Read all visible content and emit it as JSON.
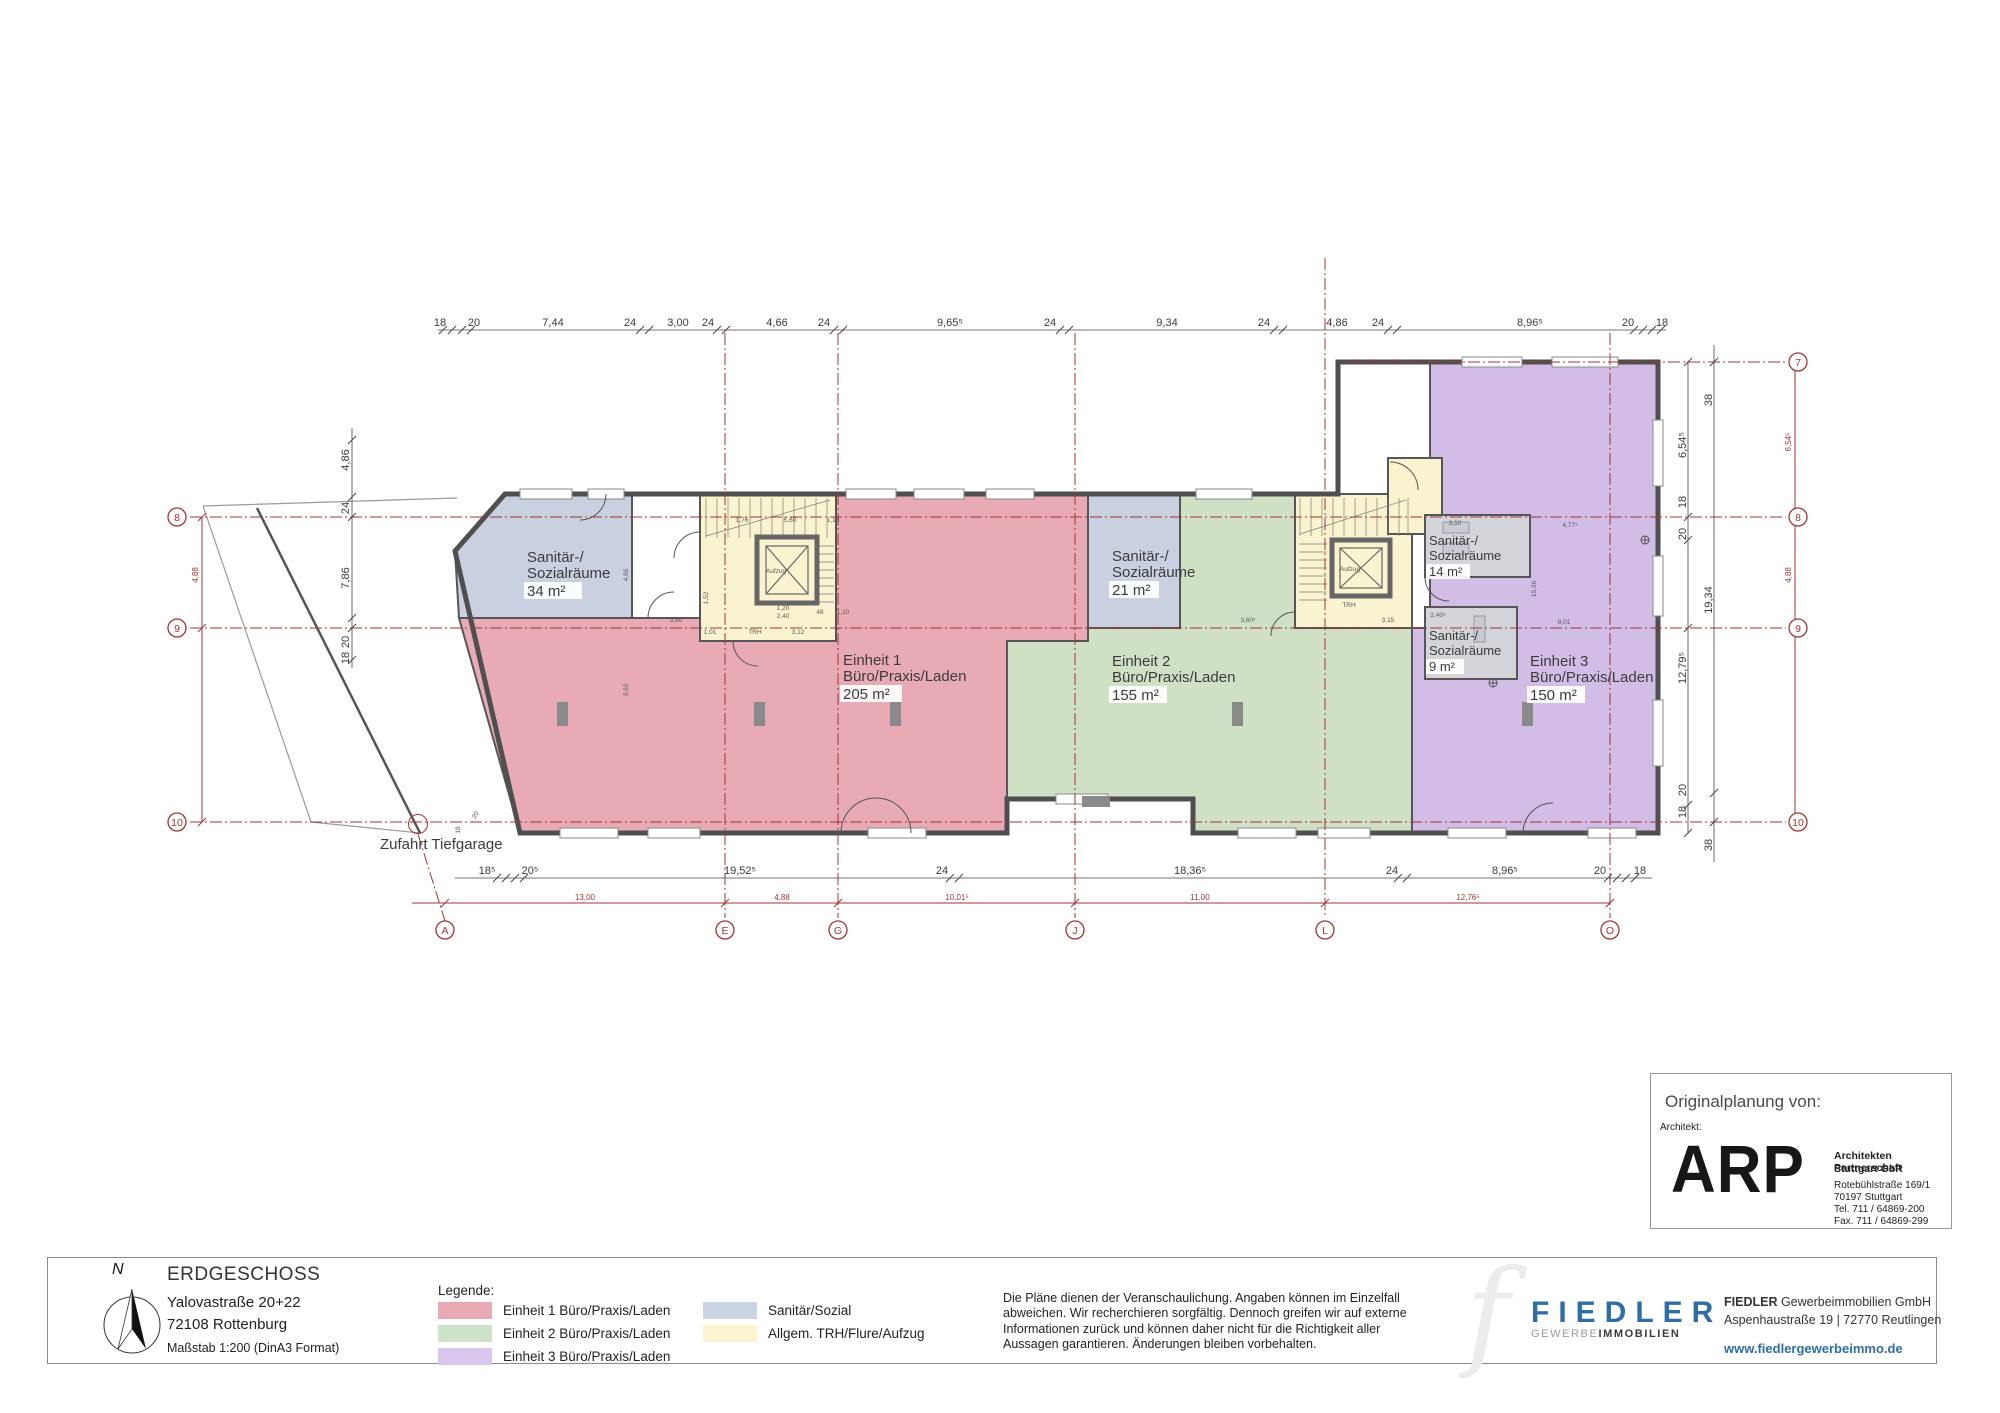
{
  "plan": {
    "colors": {
      "einheit1": "#e8aab4",
      "einheit2": "#cfe0c4",
      "einheit3": "#d2bde7",
      "sanitaer": "#c9d1e0",
      "sanitaer_block": "#d4d5da",
      "trh": "#faf3cf",
      "grid_red": "#a33434"
    },
    "rooms": {
      "s34": [
        "Sanitär-/",
        "Sozialräume",
        "34 m²"
      ],
      "e1": [
        "Einheit 1",
        "Büro/Praxis/Laden",
        "205 m²"
      ],
      "s21": [
        "Sanitär-/",
        "Sozialräume",
        "21 m²"
      ],
      "e2": [
        "Einheit 2",
        "Büro/Praxis/Laden",
        "155 m²"
      ],
      "s14": [
        "Sanitär-/",
        "Sozialräume",
        "14 m²"
      ],
      "s9": [
        "Sanitär-/",
        "Sozialräume",
        "9 m²"
      ],
      "e3": [
        "Einheit 3",
        "Büro/Praxis/Laden",
        "150 m²"
      ]
    },
    "zufahrt_label": "Zufahrt Tiefgarage",
    "grid_bubbles": [
      {
        "t": "8",
        "x": 177,
        "y": 521
      },
      {
        "t": "9",
        "x": 177,
        "y": 632
      },
      {
        "t": "10",
        "x": 177,
        "y": 826
      },
      {
        "t": "7",
        "x": 1798,
        "y": 366
      },
      {
        "t": "8",
        "x": 1798,
        "y": 521
      },
      {
        "t": "9",
        "x": 1798,
        "y": 632
      },
      {
        "t": "10",
        "x": 1798,
        "y": 826
      },
      {
        "t": "A",
        "x": 445,
        "y": 934
      },
      {
        "t": "E",
        "x": 725,
        "y": 934
      },
      {
        "t": "G",
        "x": 838,
        "y": 934
      },
      {
        "t": "J",
        "x": 1075,
        "y": 934
      },
      {
        "t": "L",
        "x": 1325,
        "y": 934
      },
      {
        "t": "O",
        "x": 1610,
        "y": 934
      }
    ],
    "top_dims": [
      {
        "t": "18",
        "x": 440,
        "y": 326
      },
      {
        "t": "20",
        "x": 474,
        "y": 326
      },
      {
        "t": "7,44",
        "x": 553,
        "y": 326
      },
      {
        "t": "24",
        "x": 630,
        "y": 326
      },
      {
        "t": "3,00",
        "x": 678,
        "y": 326
      },
      {
        "t": "24",
        "x": 708,
        "y": 326
      },
      {
        "t": "4,66",
        "x": 777,
        "y": 326
      },
      {
        "t": "24",
        "x": 824,
        "y": 326
      },
      {
        "t": "9,65⁵",
        "x": 950,
        "y": 326
      },
      {
        "t": "24",
        "x": 1050,
        "y": 326
      },
      {
        "t": "9,34",
        "x": 1167,
        "y": 326
      },
      {
        "t": "24",
        "x": 1264,
        "y": 326
      },
      {
        "t": "4,86",
        "x": 1337,
        "y": 326
      },
      {
        "t": "24",
        "x": 1378,
        "y": 326
      },
      {
        "t": "8,96⁵",
        "x": 1530,
        "y": 326
      },
      {
        "t": "20",
        "x": 1628,
        "y": 326
      },
      {
        "t": "18",
        "x": 1662,
        "y": 326
      }
    ],
    "bottom_dims": [
      {
        "t": "18⁵",
        "x": 487,
        "y": 874
      },
      {
        "t": "20⁵",
        "x": 530,
        "y": 874
      },
      {
        "t": "19,52⁵",
        "x": 740,
        "y": 874
      },
      {
        "t": "24",
        "x": 942,
        "y": 874
      },
      {
        "t": "18,36⁵",
        "x": 1190,
        "y": 874
      },
      {
        "t": "24",
        "x": 1392,
        "y": 874
      },
      {
        "t": "8,96⁵",
        "x": 1505,
        "y": 874
      },
      {
        "t": "20",
        "x": 1600,
        "y": 874
      },
      {
        "t": "18",
        "x": 1640,
        "y": 874
      }
    ],
    "red_dims": [
      {
        "t": "13,00",
        "x": 585,
        "y": 900
      },
      {
        "t": "4,88",
        "x": 782,
        "y": 900
      },
      {
        "t": "10,01⁵",
        "x": 957,
        "y": 900
      },
      {
        "t": "11,00",
        "x": 1200,
        "y": 900
      },
      {
        "t": "12,76⁵",
        "x": 1468,
        "y": 900
      }
    ],
    "side_dims": [
      {
        "t": "4,86",
        "x": 349,
        "y": 460,
        "r": -90
      },
      {
        "t": "24",
        "x": 349,
        "y": 508,
        "r": -90
      },
      {
        "t": "7,86",
        "x": 349,
        "y": 578,
        "r": -90
      },
      {
        "t": "20",
        "x": 349,
        "y": 642,
        "r": -90
      },
      {
        "t": "18",
        "x": 349,
        "y": 658,
        "r": -90
      },
      {
        "t": "38",
        "x": 1712,
        "y": 400,
        "r": -90
      },
      {
        "t": "6,54⁵",
        "x": 1686,
        "y": 445,
        "r": -90
      },
      {
        "t": "18",
        "x": 1686,
        "y": 502,
        "r": -90
      },
      {
        "t": "20",
        "x": 1686,
        "y": 534,
        "r": -90
      },
      {
        "t": "19,34",
        "x": 1712,
        "y": 600,
        "r": -90
      },
      {
        "t": "12,79⁵",
        "x": 1686,
        "y": 668,
        "r": -90
      },
      {
        "t": "20",
        "x": 1686,
        "y": 790,
        "r": -90
      },
      {
        "t": "18",
        "x": 1686,
        "y": 812,
        "r": -90
      },
      {
        "t": "38",
        "x": 1712,
        "y": 845,
        "r": -90
      }
    ],
    "red_side_dims": [
      {
        "t": "4,88",
        "x": 198,
        "y": 575,
        "r": -90
      },
      {
        "t": "6,54⁵",
        "x": 1791,
        "y": 442,
        "r": -90
      },
      {
        "t": "4,88",
        "x": 1791,
        "y": 575,
        "r": -90
      }
    ],
    "micro_dims": [
      {
        "t": "1,76",
        "x": 742,
        "y": 522
      },
      {
        "t": "5,60",
        "x": 790,
        "y": 522
      },
      {
        "t": "1,10",
        "x": 833,
        "y": 522
      },
      {
        "t": "1,52",
        "x": 708,
        "y": 598,
        "r": -90
      },
      {
        "t": "1,20",
        "x": 783,
        "y": 610
      },
      {
        "t": "2,40",
        "x": 783,
        "y": 618
      },
      {
        "t": "48",
        "x": 820,
        "y": 614
      },
      {
        "t": "1,10",
        "x": 843,
        "y": 614
      },
      {
        "t": "1,01",
        "x": 710,
        "y": 634
      },
      {
        "t": "TRH",
        "x": 755,
        "y": 634
      },
      {
        "t": "3,12",
        "x": 798,
        "y": 634
      },
      {
        "t": "Aufzug",
        "x": 776,
        "y": 573
      },
      {
        "t": "Aufzug",
        "x": 1350,
        "y": 571
      },
      {
        "t": "TRH",
        "x": 1349,
        "y": 607
      },
      {
        "t": "3,80",
        "x": 676,
        "y": 622
      },
      {
        "t": "3,60⁵",
        "x": 1248,
        "y": 622
      },
      {
        "t": "3,15",
        "x": 1388,
        "y": 622
      },
      {
        "t": "3,10",
        "x": 1455,
        "y": 525
      },
      {
        "t": "4,77⁵",
        "x": 1570,
        "y": 527
      },
      {
        "t": "8,01",
        "x": 1564,
        "y": 624
      },
      {
        "t": "15,36",
        "x": 1536,
        "y": 589,
        "r": -90
      },
      {
        "t": "2,40⁵",
        "x": 1438,
        "y": 617
      },
      {
        "t": "4,86",
        "x": 628,
        "y": 575,
        "r": -90
      },
      {
        "t": "3,62",
        "x": 628,
        "y": 690,
        "r": -90
      },
      {
        "t": "18",
        "x": 460,
        "y": 830,
        "r": -90
      },
      {
        "t": "20",
        "x": 477,
        "y": 816,
        "r": -60
      }
    ]
  },
  "legend": {
    "title": "Legende:",
    "items": [
      {
        "label": "Einheit 1 Büro/Praxis/Laden",
        "color": "#e9a9b4"
      },
      {
        "label": "Einheit 2 Büro/Praxis/Laden",
        "color": "#cfe3c9"
      },
      {
        "label": "Einheit 3 Büro/Praxis/Laden",
        "color": "#d9c6ee"
      },
      {
        "label": "Sanitär/Sozial",
        "color": "#ccd3e3"
      },
      {
        "label": "Allgem. TRH/Flure/Aufzug",
        "color": "#fbf5d2"
      }
    ]
  },
  "title_block": {
    "north_label": "N",
    "title": "ERDGESCHOSS",
    "address_line1": "Yalovastraße 20+22",
    "address_line2": "72108 Rottenburg",
    "scale": "Maßstab 1:200 (DinA3 Format)"
  },
  "disclaimer": "Die Pläne dienen der Veranschaulichung. Angaben können im Einzelfall abweichen. Wir recherchieren sorgfältig. Dennoch greifen wir auf externe Informationen zurück und können daher nicht für die Richtigkeit aller Aussagen garantieren. Änderungen bleiben vorbehalten.",
  "fiedler": {
    "logo_letter": "f",
    "brand": "FIEDLER",
    "brand_sub_light": "GEWERBE",
    "brand_sub_bold": "IMMOBILIEN",
    "brand_color": "#2e6da6",
    "company_bold": "FIEDLER",
    "company_rest": " Gewerbeimmobilien GmbH",
    "address": "Aspenhaustraße 19 | 72770 Reutlingen",
    "website": "www.fiedlergewerbeimmo.de"
  },
  "arp": {
    "heading": "Originalplanung von:",
    "subheading": "Architekt:",
    "logo": "ARP",
    "firm_line1": "Architekten Partnerschaft",
    "firm_line2": "Stuttgart GbR",
    "address1": "Rotebühlstraße 169/1",
    "address2": "70197 Stuttgart",
    "tel": "Tel.  711 / 64869-200",
    "fax": "Fax. 711 / 64869-299"
  }
}
